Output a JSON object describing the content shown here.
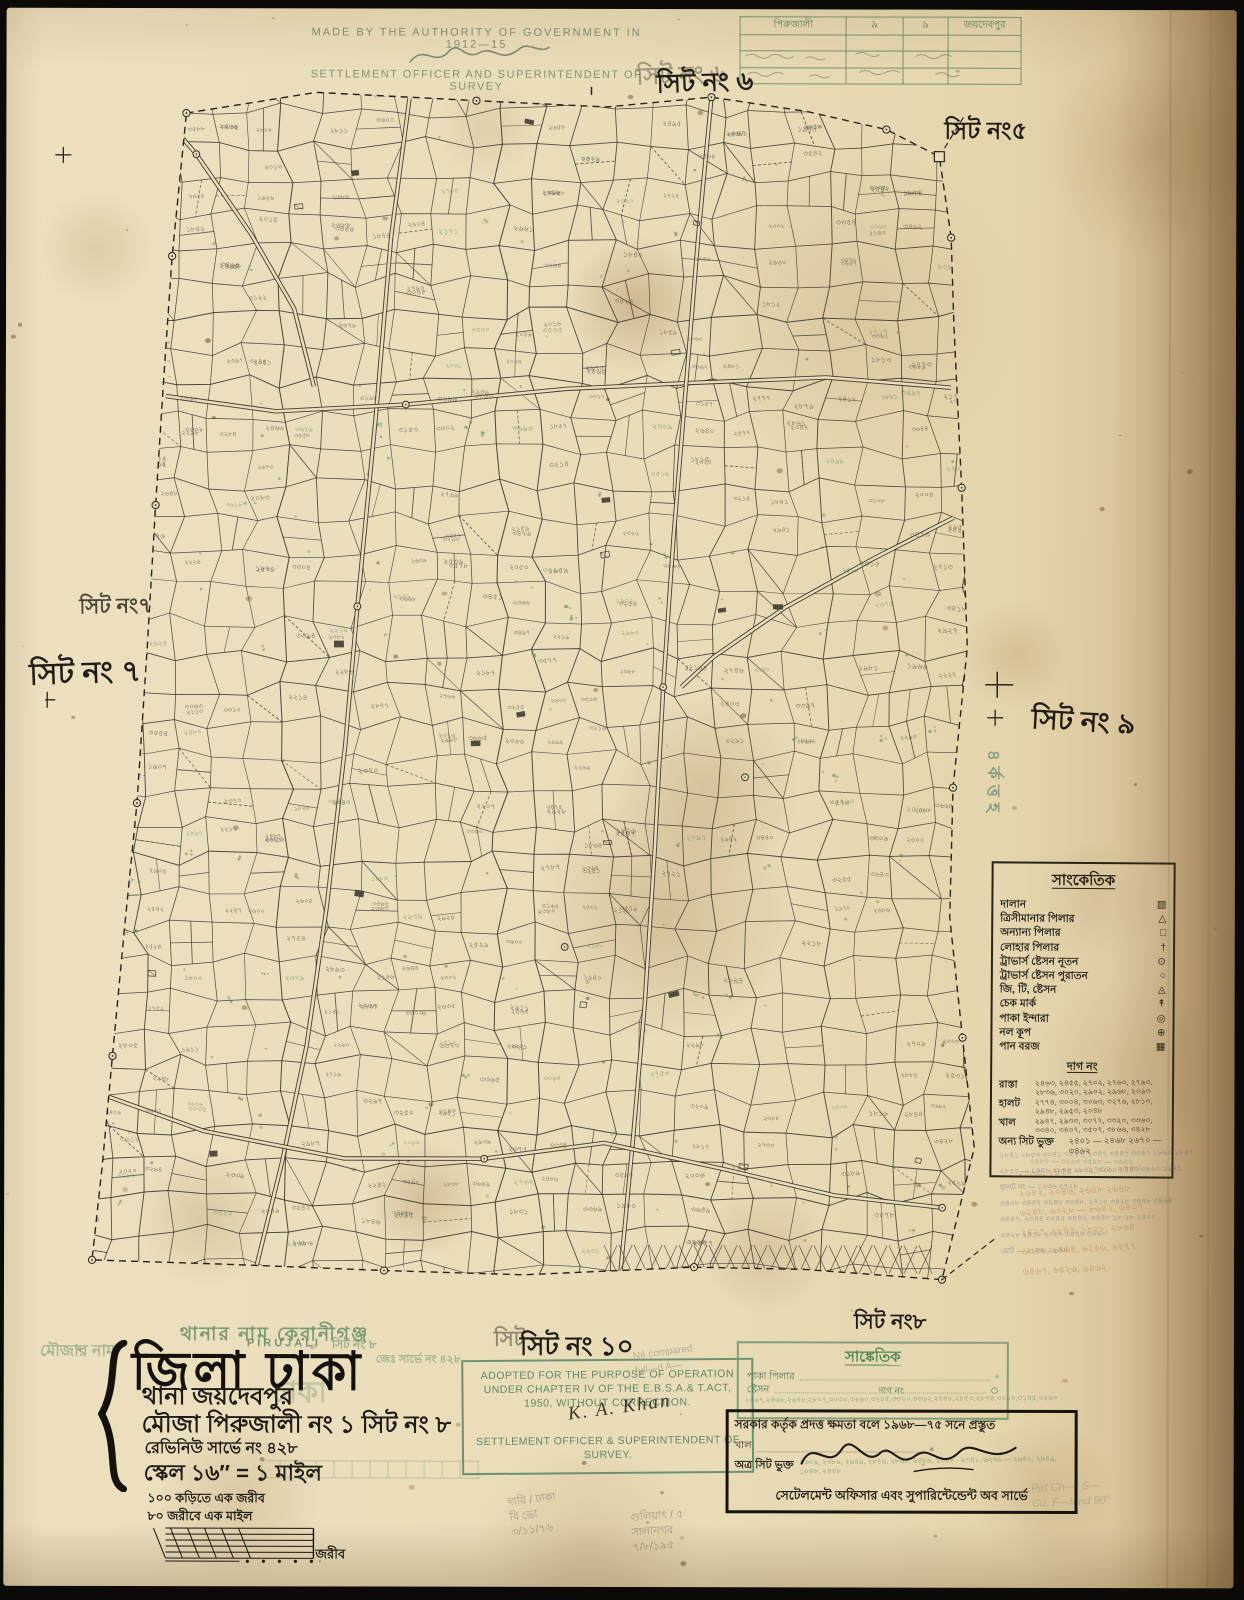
{
  "colors": {
    "paper": "#e9dcb8",
    "ink": "#211d16",
    "green_print": "#5f8a66",
    "teal_stamp": "#44786b",
    "map_line": "#3a342c",
    "rust_note": "#a8693f"
  },
  "header": {
    "authority_line": "MADE BY THE AUTHORITY OF GOVERNMENT IN 1912—15",
    "officer_line": "SETTLEMENT OFFICER AND SUPERINTENDENT OF SURVEY"
  },
  "corner_table": {
    "c1": "পিরুজালী",
    "c2": "৯",
    "c3": "৯",
    "c4": "জয়দেবপুর"
  },
  "sheet_labels": {
    "top_green": "সিট নং ৬",
    "top": "সিট নং ৬",
    "top_right": "সিট নং৫",
    "left_stamp": "সিট নং৭",
    "left": "সিট নং ৭",
    "right": "সিট নং ৯",
    "bottom_green": "সিট",
    "bottom": "সিট নং ১০",
    "bottom_right": "সিট নং৮",
    "vertical_green": "৪র্কত্তহ"
  },
  "legend": {
    "title": "সাংকেতিক",
    "items": [
      {
        "label": "দালান",
        "glyph": "▨"
      },
      {
        "label": "ত্রিসীমানার পিলার",
        "glyph": "△"
      },
      {
        "label": "অন্যান্য পিলার",
        "glyph": "□"
      },
      {
        "label": "লোহার পিলার",
        "glyph": "†"
      },
      {
        "label": "ট্রাভার্স ষ্টেসন নূতন",
        "glyph": "⊙"
      },
      {
        "label": "ট্রাভার্স ষ্টেসন পুরাতন",
        "glyph": "○"
      },
      {
        "label": "জি, টি, ষ্টেসন",
        "glyph": "◬"
      },
      {
        "label": "চেক মার্ক",
        "glyph": "↟"
      },
      {
        "label": "পাকা ইন্দারা",
        "glyph": "◎"
      },
      {
        "label": "নল কূপ",
        "glyph": "⊕"
      },
      {
        "label": "পান বরজ",
        "glyph": "▦"
      }
    ],
    "dag_heading": "দাগ নং",
    "dag_rows": [
      {
        "label": "রাস্তা",
        "numbers": "২৪৬৩, ২৪৫৫, ২৭০২, ২৭৬০, ২৭৯৩, ২৮৩৬, ৩০২০, ২৯০২, ২৯৬৮, ২০৯৩"
      },
      {
        "label": "হালট",
        "numbers": "২৭৭৪, ৩০০৪, ৩০৬৩, ৩২৭৬, ২৮১৩, ২৯৪৮, ২৯৫৩, ২০৪৮"
      },
      {
        "label": "খাল",
        "numbers": "২৯৪৭, ২৯৩৩, ৩০৭৭, ৩৩২০, ৩৩৬০, ৩৩৪০, ৩৪০৭, ৩৫০৭, ৩৮৬৬, ৩৪২৮"
      },
      {
        "label": "অন্য সিট ভুক্ত",
        "numbers": "২৪০১ — ২৪৬৮   ২৬৭০ — ৩৪৬২"
      }
    ],
    "extra_green": "৩৪৮০ — ৩৫২৩   ৩৫৯০ — ৩৬৪২"
  },
  "margin_notes": {
    "below_legend": [
      "২৮৪১ ২৮৫৩ ৩০৪১ ৩২৪৭, ১৩৪৭ ৩৪৪৭ ৩০৪০ ১৮৬০ ১৮৪৭",
      "২৮৫৫ — ২৪৪৮ ২৮৪৮ ২৮৪২, ৩২৬০ ৩৪৪০ ৩৪৬০ ২৬৪১",
      "হালট নং — ২২৩৬   ২৭২৮",
      "৩৪০৮ ৩৪৪৭ ৩২৪৮ ৩০৪৮, ২৪১০ ৩৪২৮ ৩৪৪৮ ৩৪৬৪",
      "৩৪৪৭, ২৩৪৪ ৩২৪৫ ৩৪৪৬, ৩৪৪৮ ১৮-২৮ ২৪০০",
      "৩৪২৮ ২৪১৮ ২০২৮ ৩৪২৮ ৩৪৬০",
      "মোট — ১১৩৬   ২২৩৬"
    ],
    "rust_lines": [
      "২৪৬৩, ২৪৫৫ — ২৭০২, ২৭৬০",
      "২৬৪২, ২০৪৬, ২৬৪৮ ২৬৪৮",
      "৬২৪৮, ৬০২৮ — ৮৬৪২, ৬৪০৭",
      "২৪২৭, ২৮৪৭, ১৮২৮, ২৮৬৪",
      "৬০৪৮, ৬৪৬৪, ৬২৬৬, ৬২৭৭",
      "৬৪৬৭, ৬৪২৬, ৬৪৬২"
    ],
    "pencil_1": "দায়ি / ঢাকা\nবি ভো\n৩/১১/৭৬",
    "pencil_2": "গুলিয়াৎ / ৫\nসালানগর\n৭/৮/১৯৫",
    "pencil_3": "Pirt Ch—t S—\nCu. F—land 90°",
    "pencil_4": "Né compared\nfull—d A—"
  },
  "title_block": {
    "old_thana_line": "থানার নাম কেরানীগঞ্জ",
    "pirujali_latin": "PIRUJALI",
    "green_sheet": "সিট নং ৮",
    "green_survey_no": "জেঃ সার্ভে নং ৪২৮",
    "green_mouza_col": "মৌজার নাম",
    "green_dhaka_echo": "ঢাকা",
    "district_line": "জিলা ঢাকা",
    "thana_line": "থানা জয়দেবপুর",
    "mouza_line": "মৌজা পিরুজালী নং ১ সিট নং ৮",
    "revenue_line": "রেভিনিউ সার্ভে নং ৪২৮",
    "scale_line": "স্কেল ১৬″ = ১ মাইল",
    "scale_note1": "১০০ কড়িতে এক জরীব",
    "scale_note2": "৮০ জরীবে এক মাইল",
    "scale_bar_label": "জরীব"
  },
  "stamp": {
    "line1": "ADOPTED FOR THE PURPOSE OF OPERATION",
    "line2": "UNDER CHAPTER IV OF THE E.B.S.A.& T.ACT,",
    "line3": "1950, WITHOUT CORRECTION.",
    "signature": "K. A. Khan",
    "line4": "SETTLEMENT OFFICER & SUPERINTENDENT OF",
    "line5": "SURVEY."
  },
  "mini_legend": {
    "title": "সাঙ্কেতিক",
    "row1_label": "পাকা পিলার",
    "row1_glyph": "▫",
    "row2_label": "ষ্টেসন",
    "row2_glyph": "○",
    "dag_label": "দাগ নং",
    "numbers": "২৪৬৭,২৪৬৮,২৬৪৮,২৮০৭,৩০৩০,৩২৬০,৩২৮৫,৩৩২০,৩৩৬২,২৪৪৮,২৮৫৩,২৮৭৪,৩০১০,৩১৪৫,৩২৬০"
  },
  "authorization_box": {
    "line1": "সরকার কর্তৃক প্রদত্ত ক্ষমতা বলে ১৯৬৮—৭৫ সনে প্রস্তুত",
    "khal_label": "খাল",
    "inclusion_label": "অত্র সিট ভুক্ত",
    "green_numbers": "১৩০৯, ২৩৮৯, ২৬৪৯, ২৮৪৯, ২৮৬৮, ৬৪৮৯, ১৩৪৮ · ২৩৪১, ৬২৩৬ — ২৬৪২, ২৮৪৯, ১৮৪৮, ২৪৪৮",
    "footer": "সেটেলমেন্ট অফিসার এবং সুপারিন্টেন্ডেন্ট অব সার্ভে"
  },
  "map_render": {
    "seed": 11,
    "paper": "#e9dcb8",
    "line": "#3a342c",
    "label_ink": "#4b4437",
    "green": "#6a8a57",
    "counts": {
      "sublines": 280,
      "labels": 450,
      "green": 150,
      "buildings": 22
    },
    "boundary": [
      [
        140,
        27
      ],
      [
        270,
        6
      ],
      [
        430,
        14
      ],
      [
        560,
        20
      ],
      [
        665,
        10
      ],
      [
        760,
        24
      ],
      [
        840,
        42
      ],
      [
        893,
        69
      ],
      [
        905,
        150
      ],
      [
        908,
        240
      ],
      [
        916,
        400
      ],
      [
        922,
        560
      ],
      [
        908,
        700
      ],
      [
        905,
        830
      ],
      [
        918,
        950
      ],
      [
        930,
        1060
      ],
      [
        898,
        1192
      ],
      [
        760,
        1182
      ],
      [
        650,
        1180
      ],
      [
        480,
        1188
      ],
      [
        340,
        1184
      ],
      [
        180,
        1178
      ],
      [
        48,
        1174
      ],
      [
        58,
        1080
      ],
      [
        68,
        970
      ],
      [
        80,
        840
      ],
      [
        92,
        717
      ],
      [
        102,
        560
      ],
      [
        110,
        419
      ],
      [
        118,
        290
      ],
      [
        126,
        170
      ]
    ],
    "roads": [
      [
        [
          363,
          12
        ],
        [
          345,
          150
        ],
        [
          330,
          330
        ],
        [
          312,
          520
        ],
        [
          300,
          660
        ],
        [
          282,
          820
        ],
        [
          262,
          960
        ],
        [
          238,
          1075
        ],
        [
          210,
          1190
        ]
      ],
      [
        [
          120,
          310
        ],
        [
          230,
          325
        ],
        [
          360,
          318
        ],
        [
          520,
          302
        ],
        [
          640,
          296
        ],
        [
          780,
          290
        ],
        [
          905,
          300
        ]
      ],
      [
        [
          665,
          10
        ],
        [
          652,
          150
        ],
        [
          640,
          300
        ],
        [
          628,
          450
        ],
        [
          618,
          600
        ],
        [
          610,
          760
        ],
        [
          600,
          920
        ],
        [
          588,
          1060
        ],
        [
          576,
          1190
        ]
      ],
      [
        [
          908,
          430
        ],
        [
          830,
          470
        ],
        [
          740,
          520
        ],
        [
          668,
          570
        ],
        [
          636,
          600
        ]
      ],
      [
        [
          48,
          1005
        ],
        [
          160,
          1045
        ],
        [
          300,
          1072
        ],
        [
          440,
          1072
        ],
        [
          560,
          1056
        ],
        [
          680,
          1082
        ],
        [
          790,
          1108
        ],
        [
          898,
          1120
        ]
      ],
      [
        [
          95,
          5
        ],
        [
          150,
          68
        ],
        [
          205,
          148
        ],
        [
          248,
          222
        ],
        [
          268,
          300
        ]
      ]
    ],
    "stations": [
      [
        312,
        520
      ],
      [
        618,
        600
      ],
      [
        150,
        68
      ],
      [
        360,
        318
      ],
      [
        440,
        1072
      ],
      [
        905,
        150
      ],
      [
        700,
        690
      ],
      [
        520,
        860
      ],
      [
        898,
        1120
      ]
    ],
    "zigzag": {
      "x0": 560,
      "x1": 888,
      "y0": 1158,
      "y1": 1186,
      "step": 15
    },
    "stains": [
      [
        630,
        295,
        70,
        0.5
      ],
      [
        660,
        905,
        130,
        0.4
      ],
      [
        700,
        780,
        95,
        0.35
      ],
      [
        850,
        300,
        170,
        0.25
      ],
      [
        420,
        1190,
        60,
        0.4
      ],
      [
        1010,
        645,
        55,
        0.3
      ],
      [
        1125,
        1060,
        95,
        0.3
      ],
      [
        235,
        1490,
        85,
        0.3
      ],
      [
        585,
        1545,
        115,
        0.3
      ],
      [
        1040,
        1480,
        75,
        0.3
      ],
      [
        1150,
        140,
        110,
        0.35
      ],
      [
        90,
        240,
        60,
        0.25
      ],
      [
        200,
        1210,
        70,
        0.3
      ],
      [
        1090,
        890,
        60,
        0.25
      ],
      [
        480,
        120,
        50,
        0.2
      ],
      [
        760,
        1240,
        65,
        0.3
      ]
    ]
  }
}
